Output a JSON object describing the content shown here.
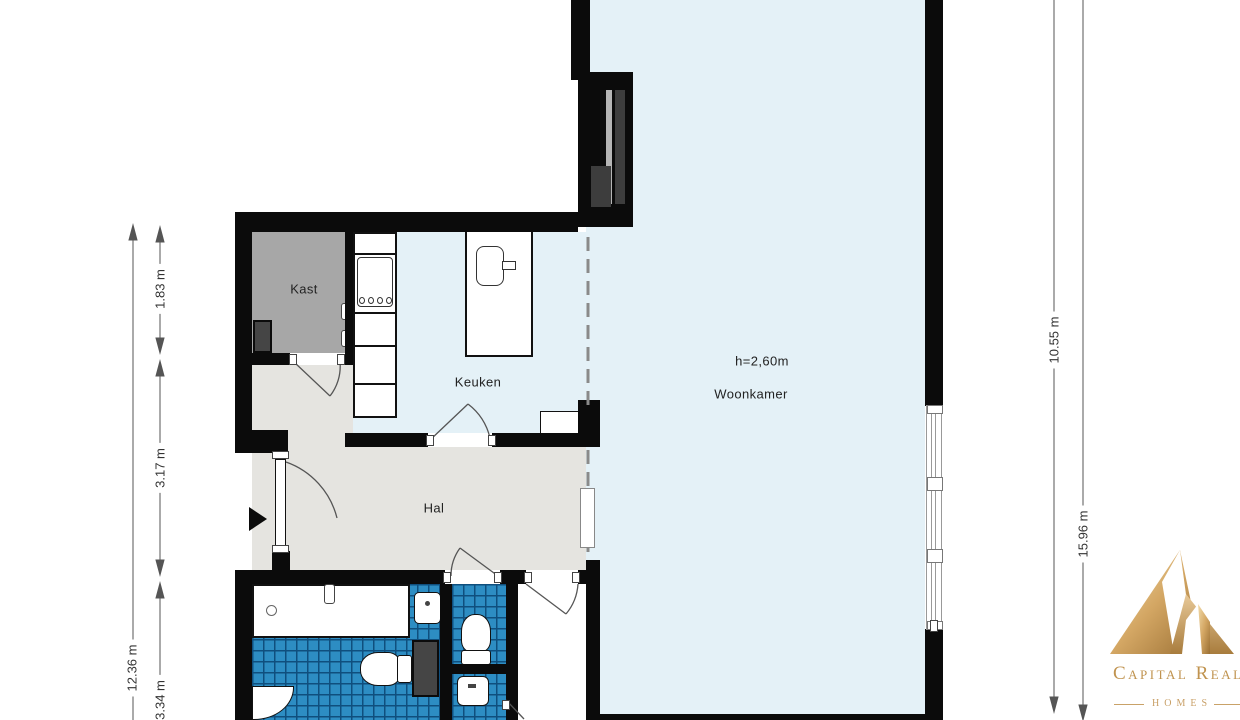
{
  "rooms": {
    "kast": "Kast",
    "keuken": "Keuken",
    "hal": "Hal",
    "woonkamer": "Woonkamer",
    "ceiling_height": "h=2,60m"
  },
  "dimensions": {
    "left_total": "12.36 m",
    "left_segment_top": "1.83 m",
    "left_segment_mid": "3.17 m",
    "left_segment_bottom": "3.34 m",
    "right_inner": "10.55 m",
    "right_outer": "15.96 m"
  },
  "logo": {
    "name": "Capital Realti",
    "sub": "HOMES"
  },
  "colors": {
    "wall": "#0b0b0b",
    "living_floor": "#e4f1f7",
    "hall_floor": "#e5e4e0",
    "closet_floor": "#a7a7a7",
    "tile_blue": "#2d8dc3",
    "logo_gold": "#c0934f"
  }
}
